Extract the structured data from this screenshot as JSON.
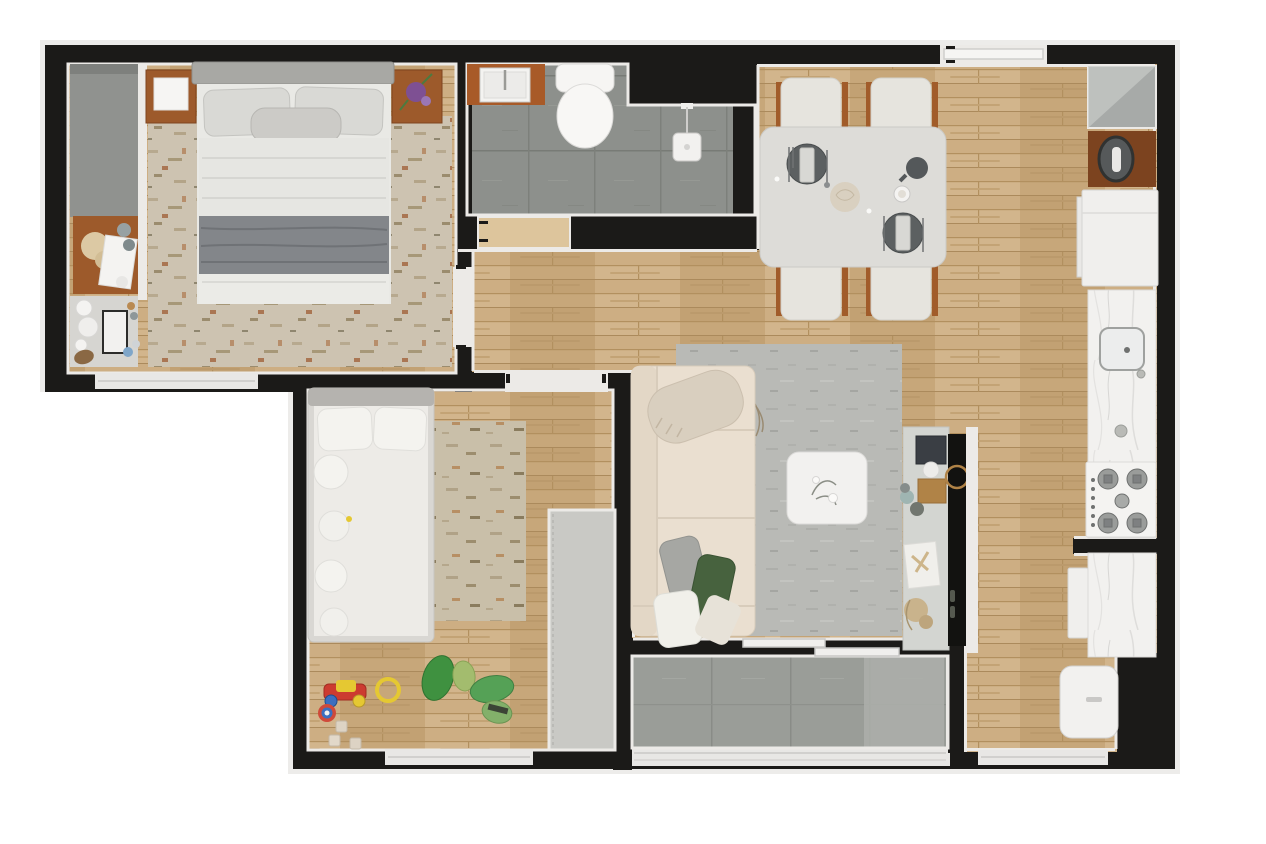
{
  "diagram": {
    "type": "floor-plan",
    "label": "Top-down 3D rendered floor plan of a two-bedroom apartment with balcony",
    "colors": {
      "wall": "#1b1a18",
      "trim": "#eceae7",
      "wood_floor": "#c9a97d",
      "bathroom_tile": "#8d908c",
      "balcony_tile": "#999c97",
      "rug_beige": "#ccc2b1",
      "rug_kids": "#c9bfa9",
      "rug_living": "#b9bab6",
      "sofa": "#eadfd0",
      "furniture_wood": "#9d5a2b",
      "marble": "#f2f1ef",
      "appliance_white": "#f0efed",
      "tv_black": "#121210",
      "console_gray": "#d3d5d1",
      "wardrobe_gray": "#c9c9c5",
      "closet_gray": "#90928f",
      "plate_dark": "#5c6061",
      "accent_green": "#47623e",
      "toy_red": "#cc3b30",
      "toy_yellow": "#e5c832",
      "toy_blue": "#3b6fc0"
    },
    "rooms": [
      {
        "id": "master-bedroom",
        "label": "Master bedroom",
        "items": [
          "double-bed",
          "pillows",
          "throw-blanket",
          "nightstand-left",
          "nightstand-right",
          "area-rug",
          "closet-niche",
          "dresser-with-pampas",
          "decor-shelf",
          "window"
        ]
      },
      {
        "id": "bathroom",
        "label": "Bathroom",
        "items": [
          "wood-vanity",
          "sink",
          "toilet",
          "shower",
          "gray-floor-tiles",
          "door-opening"
        ]
      },
      {
        "id": "dining-area",
        "label": "Dining area",
        "items": [
          "dining-table",
          "chairs-4",
          "place-settings-2",
          "centerpiece",
          "teapot",
          "cup"
        ]
      },
      {
        "id": "kitchen",
        "label": "Kitchen",
        "items": [
          "wall-cabinet",
          "wood-counter-basin",
          "refrigerator",
          "marble-counter",
          "kitchen-sink",
          "gas-cooktop",
          "lower-counter",
          "dishwasher-front",
          "washing-machine"
        ]
      },
      {
        "id": "living-room",
        "label": "Living room",
        "items": [
          "corner-sofa",
          "throw-blanket",
          "cushions",
          "area-rug",
          "coffee-table",
          "media-console",
          "tv-panel",
          "decor-plant",
          "decor-branch"
        ]
      },
      {
        "id": "kids-bedroom",
        "label": "Kids bedroom",
        "items": [
          "single-bed",
          "crochet-cushions",
          "area-rug",
          "wardrobe",
          "toy-car",
          "toy-ring",
          "toy-disc",
          "toy-blocks",
          "dinosaur-plushies",
          "window"
        ]
      },
      {
        "id": "balcony",
        "label": "Balcony",
        "items": [
          "sliding-glass-door",
          "tile-floor",
          "glass-railing"
        ]
      },
      {
        "id": "hallway",
        "label": "Hallway",
        "items": [
          "entry-sliding-door",
          "bedroom-door-opening",
          "kids-door-opening",
          "bathroom-door-opening"
        ]
      }
    ]
  }
}
